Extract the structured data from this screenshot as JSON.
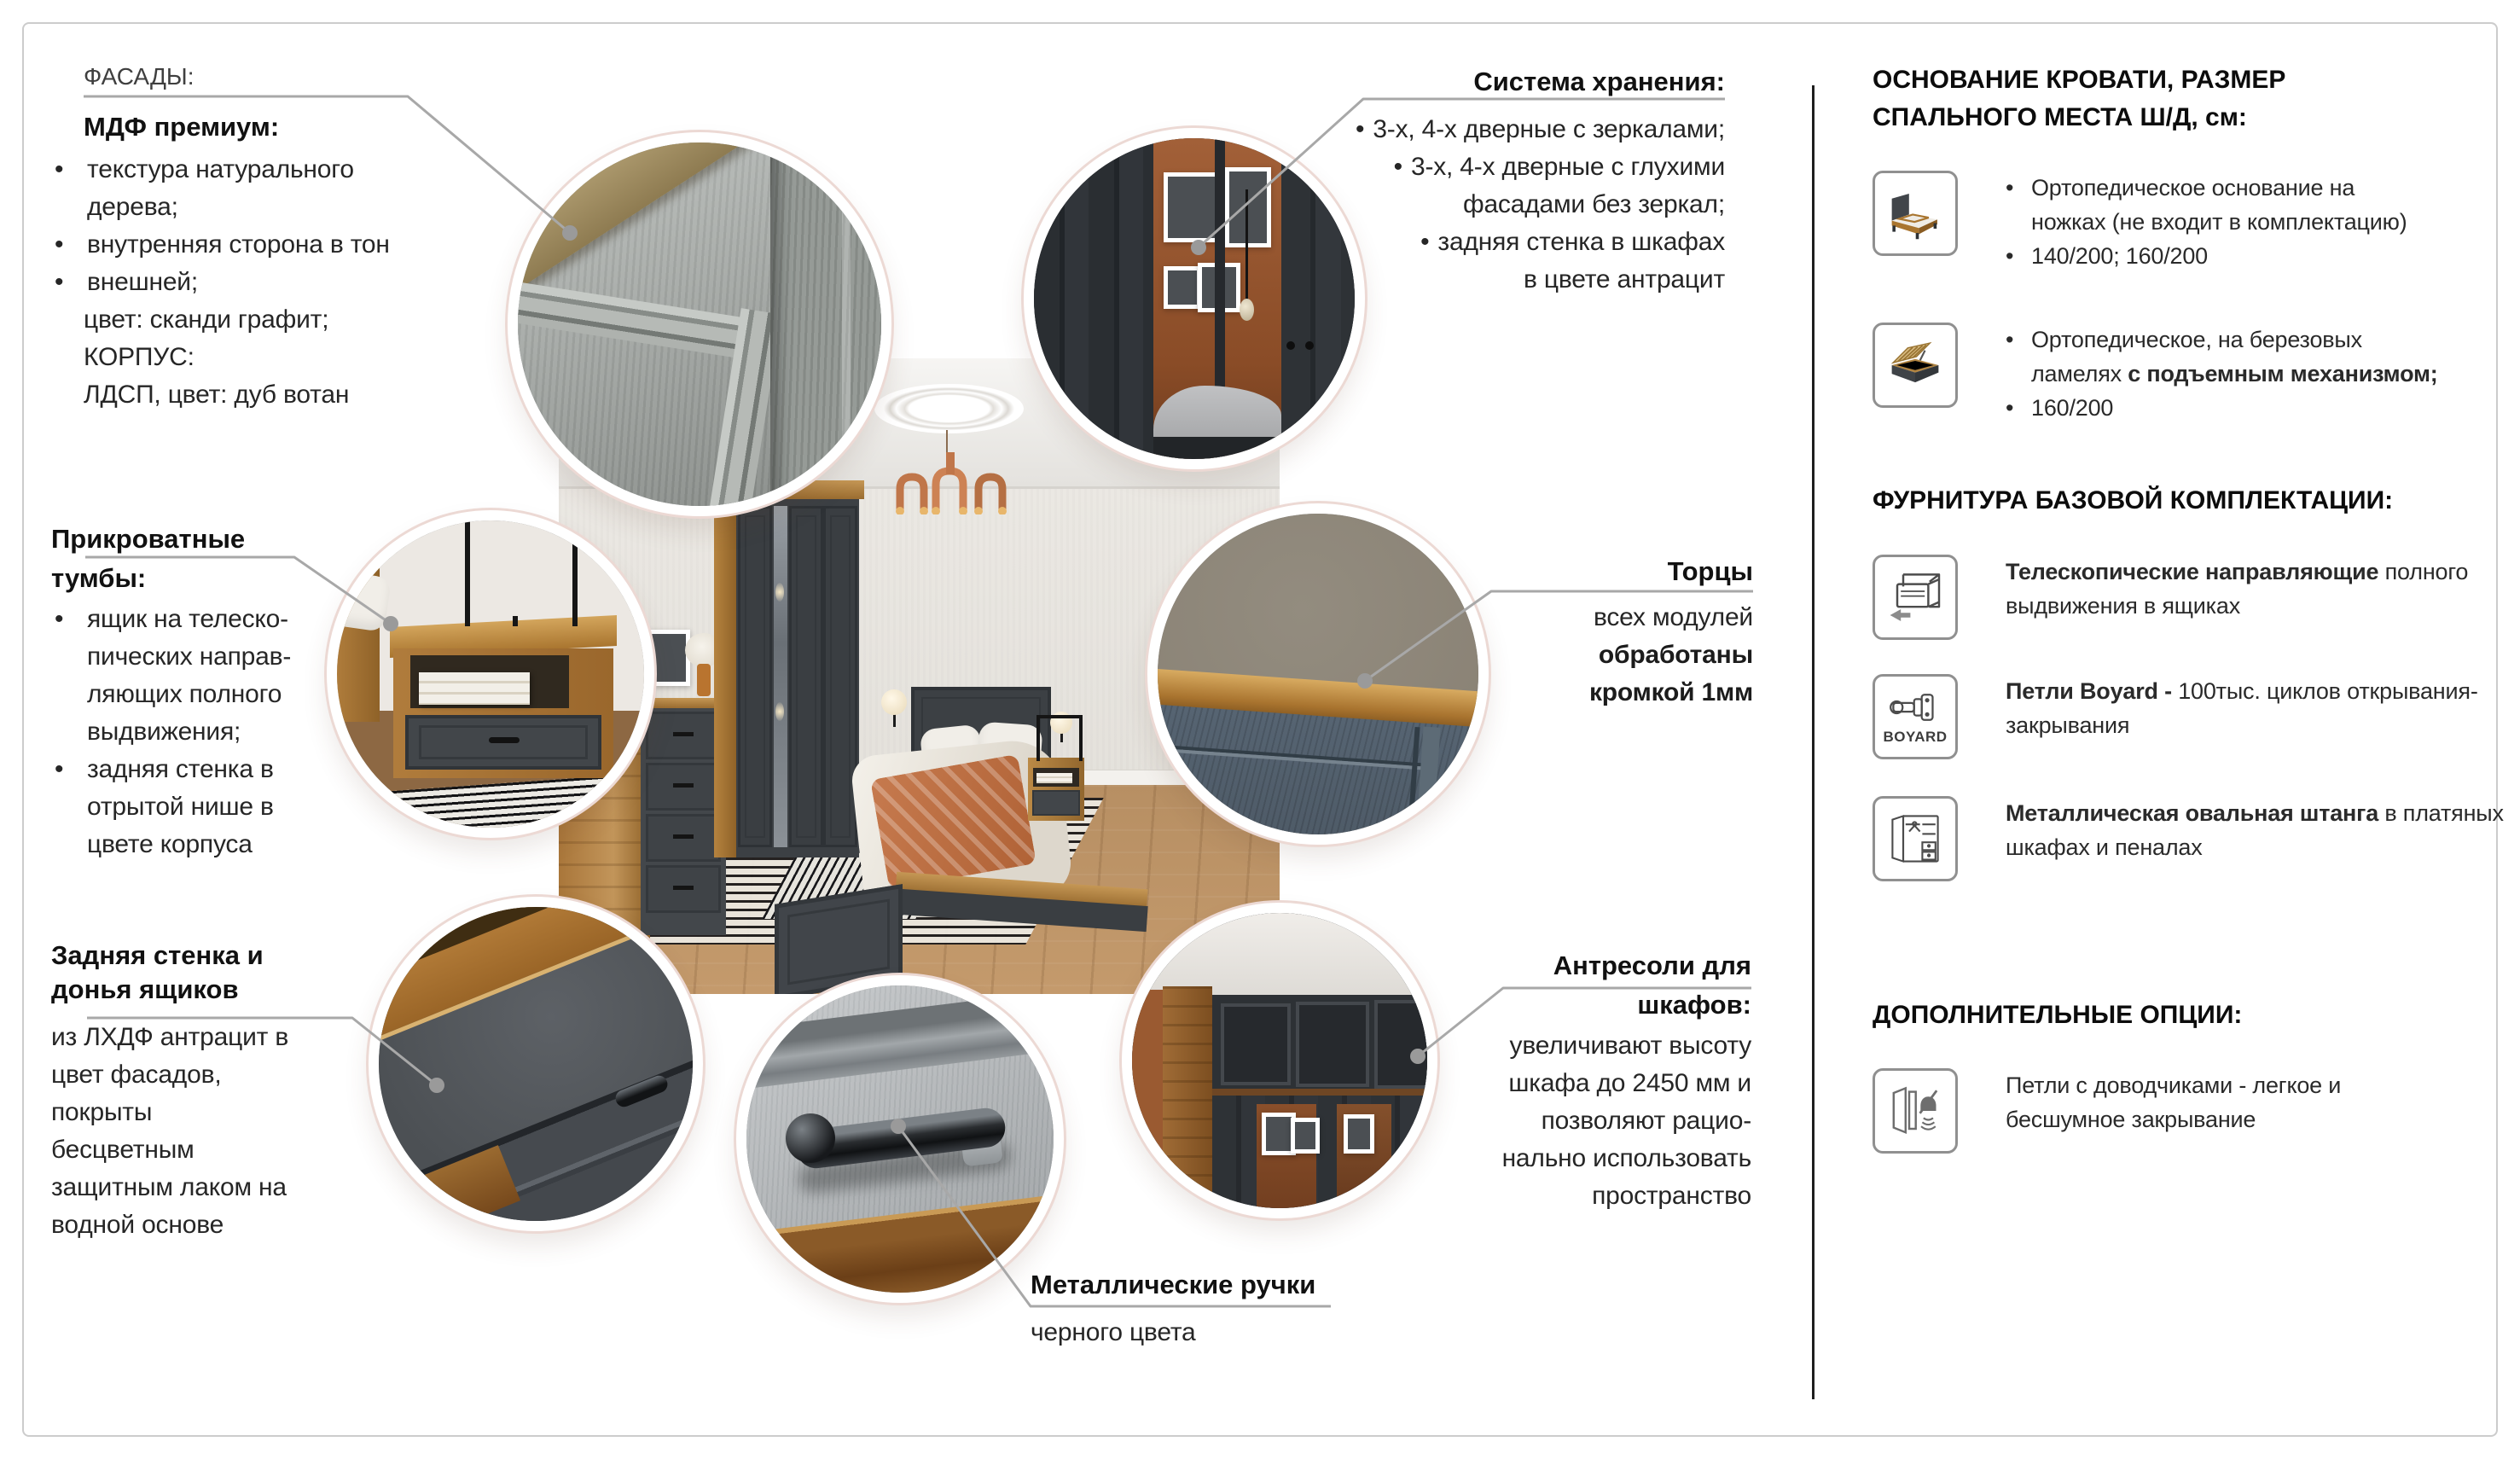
{
  "ui": {
    "bullet": "•"
  },
  "callouts": {
    "fasady": {
      "label": "ФАСАДЫ:",
      "subtitle": "МДФ премиум:",
      "b1": "текстура натурального\nдерева;",
      "b2": "внутренняя сторона в тон",
      "b3": "внешней;",
      "tail": "цвет: сканди графит;\nКОРПУС:\nЛДСП, цвет: дуб вотан"
    },
    "storage": {
      "title": "Система хранения:",
      "b1": "3-х, 4-х дверные с зеркалами;",
      "b2": "3-х, 4-х дверные с глухими\nфасадами без зеркал;",
      "b3": "задняя стенка в шкафах\nв цвете антрацит"
    },
    "nightstands": {
      "title1": "Прикроватные",
      "title2": "тумбы:",
      "b1": "ящик на телеско-\nпических направ-\nляющих полного\nвыдвижения;",
      "b2": "задняя стенка в\nотрытой нише в\nцвете корпуса"
    },
    "torcy": {
      "title": "Торцы",
      "line1": "всех модулей",
      "line2": "обработаны\nкромкой 1мм"
    },
    "back_wall": {
      "title": "Задняя стенка и\nдонья ящиков",
      "body": "из ЛХДФ антрацит в\nцвет фасадов,\nпокрыты\nбесцветным\nзащитным лаком на\nводной основе"
    },
    "handles": {
      "title": "Металлические ручки",
      "body": "черного цвета"
    },
    "antresoli": {
      "title1": "Антресоли для",
      "title2": "шкафов:",
      "body": "увеличивают высоту\nшкафа до 2450 мм и\nпозволяют рацио-\nнально использовать\nпространство"
    }
  },
  "sidebar": {
    "beds_title": "ОСНОВАНИЕ КРОВАТИ, РАЗМЕР\nСПАЛЬНОГО МЕСТА Ш/Д, см:",
    "bed1": {
      "line1": "Ортопедическое основание на\nножках (не входит в комплектацию)",
      "size": "140/200; 160/200"
    },
    "bed2": {
      "pre": "Ортопедическое, на березовых\nламелях ",
      "bold": "с подъемным механизмом;",
      "size": "160/200"
    },
    "hardware_title": "ФУРНИТУРА БАЗОВОЙ КОМПЛЕКТАЦИИ:",
    "hw1": {
      "lead": "Телескопические направляющие",
      "rest": "полного выдвижения в ящиках"
    },
    "hw2": {
      "lead": "Петли Boyard -",
      "rest": "100тыс. циклов открывания-закрывания",
      "logo": "BOYARD"
    },
    "hw3": {
      "lead": "Металлическая овальная штанга",
      "rest": "в платяных шкафах и пеналах"
    },
    "options_title": "ДОПОЛНИТЕЛЬНЫЕ ОПЦИИ:",
    "opt1": {
      "text": "Петли с доводчиками - легкое и\nбесшумное закрывание"
    }
  }
}
